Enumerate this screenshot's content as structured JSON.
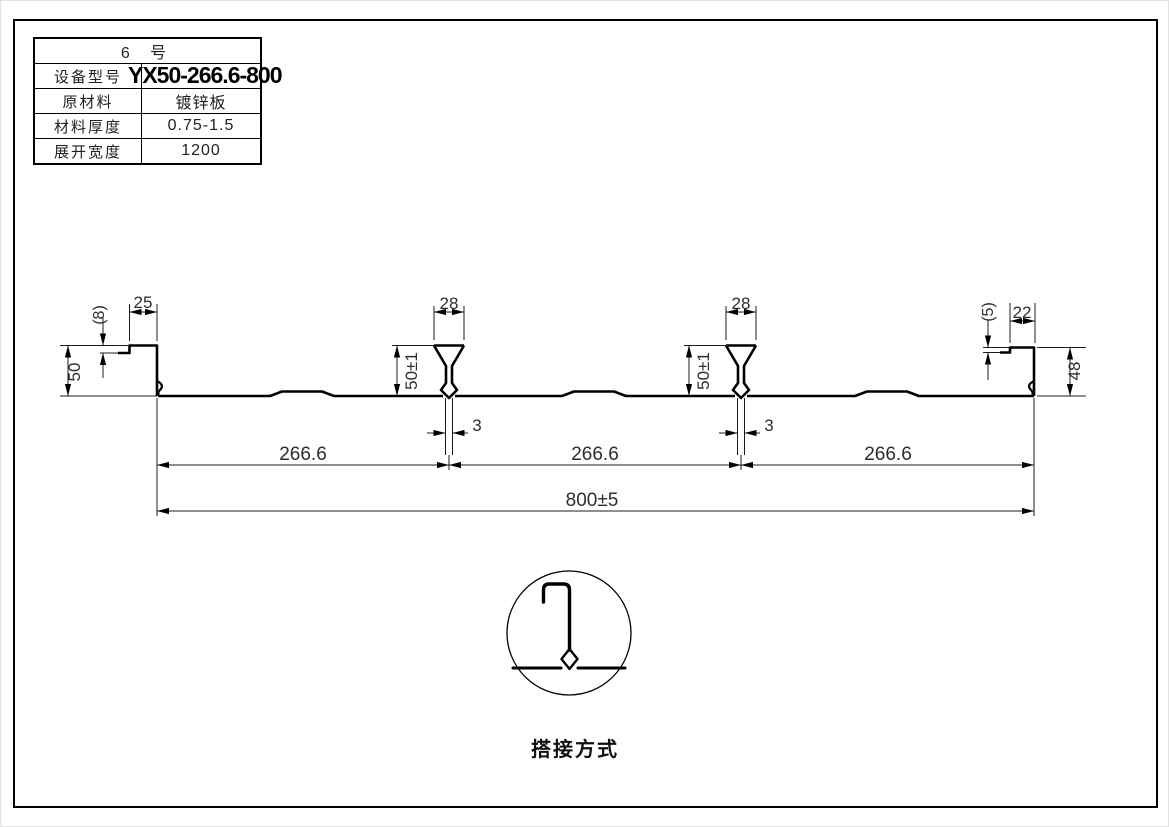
{
  "title_block": {
    "header": "6 号",
    "rows": [
      {
        "label": "设备型号",
        "value": "YX50-266.6-800"
      },
      {
        "label": "原材料",
        "value": "镀锌板"
      },
      {
        "label": "材料厚度",
        "value": "0.75-1.5"
      },
      {
        "label": "展开宽度",
        "value": "1200"
      }
    ]
  },
  "dims": {
    "left_lip": "(8)",
    "left_top_width": "25",
    "left_height": "50",
    "rib_top_widths": [
      "28",
      "28"
    ],
    "rib_heights": [
      "50±1",
      "50±1"
    ],
    "rib_bottom_gaps": [
      "3",
      "3"
    ],
    "right_lip": "(5)",
    "right_top_width": "22",
    "right_height": "48",
    "spans": [
      "266.6",
      "266.6",
      "266.6"
    ],
    "overall_width": "800±5"
  },
  "detail": {
    "caption": "搭接方式"
  },
  "colors": {
    "line": "#000000",
    "dim_text": "#2d2d2d"
  }
}
